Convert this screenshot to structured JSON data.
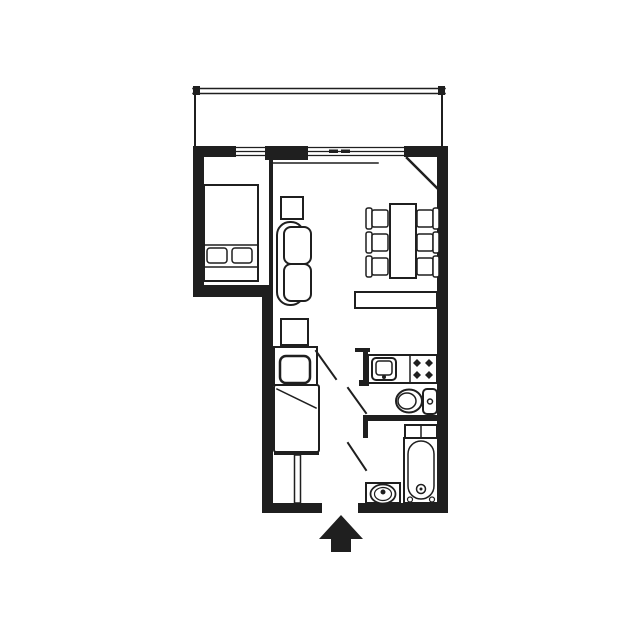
{
  "canvas": {
    "width": 640,
    "height": 640,
    "bg": "#ffffff",
    "ink": "#1f1f1f"
  },
  "plan": {
    "shapes": [
      {
        "n": "balcony-railing-top-outer",
        "t": "line",
        "x1": 193,
        "y1": 88.5,
        "x2": 445,
        "y2": 88.5,
        "sw": 1.5
      },
      {
        "n": "balcony-railing-top-inner",
        "t": "line",
        "x1": 193,
        "y1": 93.5,
        "x2": 445,
        "y2": 93.5,
        "sw": 1.5
      },
      {
        "n": "balcony-railing-cap-left",
        "t": "rect",
        "x": 193,
        "y": 86,
        "w": 7,
        "h": 9
      },
      {
        "n": "balcony-railing-cap-right",
        "t": "rect",
        "x": 438,
        "y": 86,
        "w": 7,
        "h": 9
      },
      {
        "n": "balcony-railing-left",
        "t": "line",
        "x1": 195,
        "y1": 94,
        "x2": 195,
        "y2": 146,
        "sw": 2
      },
      {
        "n": "balcony-railing-right",
        "t": "line",
        "x1": 442,
        "y1": 94,
        "x2": 442,
        "y2": 146,
        "sw": 2
      },
      {
        "n": "wall-top",
        "t": "rect",
        "x": 193,
        "y": 146,
        "w": 255,
        "h": 11
      },
      {
        "n": "window-bedroom-opening",
        "t": "wrect",
        "x": 236,
        "y": 146,
        "w": 31,
        "h": 11
      },
      {
        "n": "window-bedroom-line-1",
        "t": "line",
        "x1": 236,
        "y1": 147.5,
        "x2": 267,
        "y2": 147.5,
        "sw": 1.3
      },
      {
        "n": "window-bedroom-line-2",
        "t": "line",
        "x1": 236,
        "y1": 151.5,
        "x2": 267,
        "y2": 151.5,
        "sw": 1.3
      },
      {
        "n": "window-bedroom-line-3",
        "t": "line",
        "x1": 236,
        "y1": 155.5,
        "x2": 267,
        "y2": 155.5,
        "sw": 1.3
      },
      {
        "n": "wall-pillar-center",
        "t": "rect",
        "x": 265,
        "y": 146,
        "w": 43,
        "h": 14
      },
      {
        "n": "window-living-opening",
        "t": "wrect",
        "x": 308,
        "y": 146,
        "w": 96,
        "h": 11
      },
      {
        "n": "window-living-line-1",
        "t": "line",
        "x1": 308,
        "y1": 147.5,
        "x2": 404,
        "y2": 147.5,
        "sw": 1.3
      },
      {
        "n": "window-living-line-2",
        "t": "line",
        "x1": 308,
        "y1": 151.5,
        "x2": 404,
        "y2": 151.5,
        "sw": 1.3
      },
      {
        "n": "window-living-line-3",
        "t": "line",
        "x1": 308,
        "y1": 155.5,
        "x2": 404,
        "y2": 155.5,
        "sw": 1.3
      },
      {
        "n": "window-living-tick-1",
        "t": "rect",
        "x": 329,
        "y": 149.5,
        "w": 9,
        "h": 3.5
      },
      {
        "n": "window-living-tick-2",
        "t": "rect",
        "x": 341,
        "y": 149.5,
        "w": 9,
        "h": 3.5
      },
      {
        "n": "wall-left-upper",
        "t": "rect",
        "x": 193,
        "y": 146,
        "w": 11,
        "h": 151
      },
      {
        "n": "wall-bedroom-south",
        "t": "rect",
        "x": 193,
        "y": 285,
        "w": 80,
        "h": 12
      },
      {
        "n": "wall-left-lower",
        "t": "rect",
        "x": 262,
        "y": 285,
        "w": 11,
        "h": 228
      },
      {
        "n": "wall-right",
        "t": "rect",
        "x": 437,
        "y": 146,
        "w": 11,
        "h": 367
      },
      {
        "n": "wall-bottom-left",
        "t": "rect",
        "x": 262,
        "y": 503,
        "w": 60,
        "h": 10
      },
      {
        "n": "wall-bottom-right",
        "t": "rect",
        "x": 358,
        "y": 503,
        "w": 90,
        "h": 10
      },
      {
        "n": "wall-wc-south",
        "t": "rect",
        "x": 363,
        "y": 415,
        "w": 85,
        "h": 6
      },
      {
        "n": "wall-kitchen-stub-top",
        "t": "rect",
        "x": 355,
        "y": 348,
        "w": 15,
        "h": 4
      },
      {
        "n": "wall-kitchen-stub-side",
        "t": "rect",
        "x": 363,
        "y": 352,
        "w": 5,
        "h": 28
      },
      {
        "n": "wall-kitchen-stub-foot",
        "t": "rect",
        "x": 359,
        "y": 380,
        "w": 10,
        "h": 6
      },
      {
        "n": "wall-bath-west-stub",
        "t": "rect",
        "x": 363,
        "y": 421,
        "w": 5,
        "h": 17
      },
      {
        "n": "partition-bedroom",
        "t": "rect",
        "x": 269,
        "y": 160,
        "w": 4,
        "h": 125
      },
      {
        "n": "balcony-door-leaf",
        "t": "line",
        "x1": 407,
        "y1": 158,
        "x2": 441,
        "y2": 192,
        "sw": 2.5
      },
      {
        "n": "sliding-door-tick",
        "t": "line",
        "x1": 271,
        "y1": 157,
        "x2": 271,
        "y2": 164,
        "sw": 2
      },
      {
        "n": "sliding-door-track",
        "t": "line",
        "x1": 271,
        "y1": 163,
        "x2": 378,
        "y2": 163,
        "sw": 1.5
      },
      {
        "n": "bed-frame",
        "t": "orect",
        "x": 204,
        "y": 185,
        "w": 54,
        "h": 96,
        "sw": 2
      },
      {
        "n": "bed-pillow-band-top",
        "t": "line",
        "x1": 204,
        "y1": 245,
        "x2": 258,
        "y2": 245,
        "sw": 1.5
      },
      {
        "n": "bed-footboard-line",
        "t": "line",
        "x1": 204,
        "y1": 267,
        "x2": 258,
        "y2": 267,
        "sw": 1.5
      },
      {
        "n": "bed-pillow-left",
        "t": "orect",
        "x": 207,
        "y": 248,
        "w": 20,
        "h": 15,
        "r": 3,
        "sw": 1.5
      },
      {
        "n": "bed-pillow-right",
        "t": "orect",
        "x": 232,
        "y": 248,
        "w": 20,
        "h": 15,
        "r": 3,
        "sw": 1.5
      },
      {
        "n": "side-table",
        "t": "orect",
        "x": 281,
        "y": 197,
        "w": 22,
        "h": 22,
        "sw": 2
      },
      {
        "n": "sofa-backrest",
        "t": "orect",
        "x": 277,
        "y": 222,
        "w": 27,
        "h": 83,
        "r": 13,
        "sw": 2
      },
      {
        "n": "sofa-cushion-top",
        "t": "orect",
        "x": 284,
        "y": 227,
        "w": 27,
        "h": 37,
        "r": 7,
        "sw": 2
      },
      {
        "n": "sofa-cushion-bottom",
        "t": "orect",
        "x": 284,
        "y": 264,
        "w": 27,
        "h": 37,
        "r": 7,
        "sw": 2
      },
      {
        "n": "sofa-side-cabinet",
        "t": "orect",
        "x": 281,
        "y": 319,
        "w": 27,
        "h": 26,
        "sw": 2
      },
      {
        "n": "dining-table",
        "t": "orect",
        "x": 390,
        "y": 204,
        "w": 26,
        "h": 74,
        "sw": 2
      },
      {
        "n": "chair-left-1-back",
        "t": "orect",
        "x": 366,
        "y": 208,
        "w": 6,
        "h": 21,
        "r": 2,
        "sw": 1.5
      },
      {
        "n": "chair-left-1-seat",
        "t": "orect",
        "x": 372,
        "y": 210,
        "w": 16,
        "h": 17,
        "r": 2,
        "sw": 1.5
      },
      {
        "n": "chair-left-2-back",
        "t": "orect",
        "x": 366,
        "y": 232,
        "w": 6,
        "h": 21,
        "r": 2,
        "sw": 1.5
      },
      {
        "n": "chair-left-2-seat",
        "t": "orect",
        "x": 372,
        "y": 234,
        "w": 16,
        "h": 17,
        "r": 2,
        "sw": 1.5
      },
      {
        "n": "chair-left-3-back",
        "t": "orect",
        "x": 366,
        "y": 256,
        "w": 6,
        "h": 21,
        "r": 2,
        "sw": 1.5
      },
      {
        "n": "chair-left-3-seat",
        "t": "orect",
        "x": 372,
        "y": 258,
        "w": 16,
        "h": 17,
        "r": 2,
        "sw": 1.5
      },
      {
        "n": "chair-right-1-seat",
        "t": "orect",
        "x": 417,
        "y": 210,
        "w": 16,
        "h": 17,
        "r": 2,
        "sw": 1.5
      },
      {
        "n": "chair-right-1-back",
        "t": "orect",
        "x": 433,
        "y": 208,
        "w": 6,
        "h": 21,
        "r": 2,
        "sw": 1.5
      },
      {
        "n": "chair-right-2-seat",
        "t": "orect",
        "x": 417,
        "y": 234,
        "w": 16,
        "h": 17,
        "r": 2,
        "sw": 1.5
      },
      {
        "n": "chair-right-2-back",
        "t": "orect",
        "x": 433,
        "y": 232,
        "w": 6,
        "h": 21,
        "r": 2,
        "sw": 1.5
      },
      {
        "n": "chair-right-3-seat",
        "t": "orect",
        "x": 417,
        "y": 258,
        "w": 16,
        "h": 17,
        "r": 2,
        "sw": 1.5
      },
      {
        "n": "chair-right-3-back",
        "t": "orect",
        "x": 433,
        "y": 256,
        "w": 6,
        "h": 21,
        "r": 2,
        "sw": 1.5
      },
      {
        "n": "sideboard",
        "t": "orect",
        "x": 355,
        "y": 292,
        "w": 82,
        "h": 16,
        "sw": 2
      },
      {
        "n": "kitchen-sink-unit",
        "t": "orect",
        "x": 274,
        "y": 347,
        "w": 43,
        "h": 38,
        "sw": 2
      },
      {
        "n": "kitchen-sink-west",
        "t": "orect",
        "x": 280,
        "y": 356,
        "w": 30,
        "h": 27,
        "r": 6,
        "sw": 2.5
      },
      {
        "n": "kitchen-lower-unit",
        "t": "orect",
        "x": 274,
        "y": 385,
        "w": 45,
        "h": 67,
        "r": 2,
        "sw": 2
      },
      {
        "n": "kitchen-counter-diagonal",
        "t": "line",
        "x1": 277,
        "y1": 389,
        "x2": 316,
        "y2": 408,
        "sw": 1.5
      },
      {
        "n": "closet-cap",
        "t": "rect",
        "x": 274,
        "y": 452,
        "w": 45,
        "h": 3
      },
      {
        "n": "closet-partition",
        "t": "orect",
        "x": 294.5,
        "y": 455,
        "w": 6,
        "h": 48,
        "sw": 1.5
      },
      {
        "n": "corridor-door-leaf",
        "t": "line",
        "x1": 316,
        "y1": 351,
        "x2": 336,
        "y2": 379,
        "sw": 2
      },
      {
        "n": "kitchen-counter-east",
        "t": "orect",
        "x": 368,
        "y": 355,
        "w": 69,
        "h": 28,
        "sw": 2
      },
      {
        "n": "kitchen-counter-divider",
        "t": "line",
        "x1": 410,
        "y1": 355,
        "x2": 410,
        "y2": 383,
        "sw": 1.5
      },
      {
        "n": "kitchen-sink-east-outer",
        "t": "orect",
        "x": 372,
        "y": 358,
        "w": 24,
        "h": 22,
        "r": 4,
        "sw": 2
      },
      {
        "n": "kitchen-sink-east-inner",
        "t": "orect",
        "x": 376,
        "y": 361,
        "w": 16,
        "h": 14,
        "r": 3,
        "sw": 1.5
      },
      {
        "n": "kitchen-sink-east-drain",
        "t": "fcircle",
        "cx": 384,
        "cy": 377,
        "r": 2
      },
      {
        "n": "stove-burner-1",
        "t": "diamond",
        "cx": 417,
        "cy": 363,
        "r": 4
      },
      {
        "n": "stove-burner-2",
        "t": "diamond",
        "cx": 429,
        "cy": 363,
        "r": 4
      },
      {
        "n": "stove-burner-3",
        "t": "diamond",
        "cx": 417,
        "cy": 375,
        "r": 4
      },
      {
        "n": "stove-burner-4",
        "t": "diamond",
        "cx": 429,
        "cy": 375,
        "r": 4
      },
      {
        "n": "toilet-bowl-outer",
        "t": "oellipse",
        "cx": 409,
        "cy": 401,
        "rx": 13,
        "ry": 11.5,
        "sw": 2
      },
      {
        "n": "toilet-bowl-inner",
        "t": "oellipse",
        "cx": 407,
        "cy": 401,
        "rx": 9,
        "ry": 8,
        "sw": 1.5
      },
      {
        "n": "toilet-tank",
        "t": "orect",
        "x": 423,
        "y": 389,
        "w": 14,
        "h": 25,
        "r": 4,
        "sw": 2
      },
      {
        "n": "toilet-flush-button",
        "t": "ocircle",
        "cx": 430,
        "cy": 401.5,
        "r": 2.5,
        "sw": 1.5
      },
      {
        "n": "wc-door-leaf",
        "t": "line",
        "x1": 348,
        "y1": 388,
        "x2": 366,
        "y2": 413,
        "sw": 2
      },
      {
        "n": "bath-shelf",
        "t": "orect",
        "x": 405,
        "y": 425,
        "w": 32,
        "h": 13,
        "sw": 2
      },
      {
        "n": "bath-shelf-divider",
        "t": "line",
        "x1": 421,
        "y1": 425,
        "x2": 421,
        "y2": 438,
        "sw": 1.5
      },
      {
        "n": "bathtub-outer",
        "t": "orect",
        "x": 404,
        "y": 438,
        "w": 34,
        "h": 65,
        "sw": 2
      },
      {
        "n": "bathtub-inner",
        "t": "orect",
        "x": 408,
        "y": 441,
        "w": 26,
        "h": 58,
        "r": 13,
        "sw": 1.5
      },
      {
        "n": "bathtub-drain",
        "t": "ocircle",
        "cx": 421,
        "cy": 489,
        "r": 4.5,
        "sw": 1.5
      },
      {
        "n": "bathtub-drain-dot",
        "t": "fcircle",
        "cx": 421,
        "cy": 489,
        "r": 1.5
      },
      {
        "n": "bathtub-tap-left",
        "t": "ocircle",
        "cx": 410,
        "cy": 499.5,
        "r": 2.5,
        "sw": 1.2
      },
      {
        "n": "bathtub-tap-right",
        "t": "ocircle",
        "cx": 432,
        "cy": 499.5,
        "r": 2.5,
        "sw": 1.2
      },
      {
        "n": "vanity-counter",
        "t": "orect",
        "x": 366,
        "y": 483,
        "w": 34,
        "h": 20,
        "sw": 2
      },
      {
        "n": "washbasin-outer",
        "t": "oellipse",
        "cx": 383,
        "cy": 494,
        "rx": 12.5,
        "ry": 9.5,
        "sw": 1.8
      },
      {
        "n": "washbasin-inner",
        "t": "oellipse",
        "cx": 383,
        "cy": 494,
        "rx": 8.5,
        "ry": 6.5,
        "sw": 1.2
      },
      {
        "n": "washbasin-faucet",
        "t": "fcircle",
        "cx": 383,
        "cy": 492,
        "r": 2.5
      },
      {
        "n": "bath-door-leaf",
        "t": "line",
        "x1": 348,
        "y1": 443,
        "x2": 366,
        "y2": 470,
        "sw": 2
      },
      {
        "n": "entrance-arrow",
        "t": "poly",
        "pts": [
          [
            341,
            515
          ],
          [
            363,
            539
          ],
          [
            351,
            539
          ],
          [
            351,
            552
          ],
          [
            331,
            552
          ],
          [
            331,
            539
          ],
          [
            319,
            539
          ]
        ]
      }
    ]
  }
}
